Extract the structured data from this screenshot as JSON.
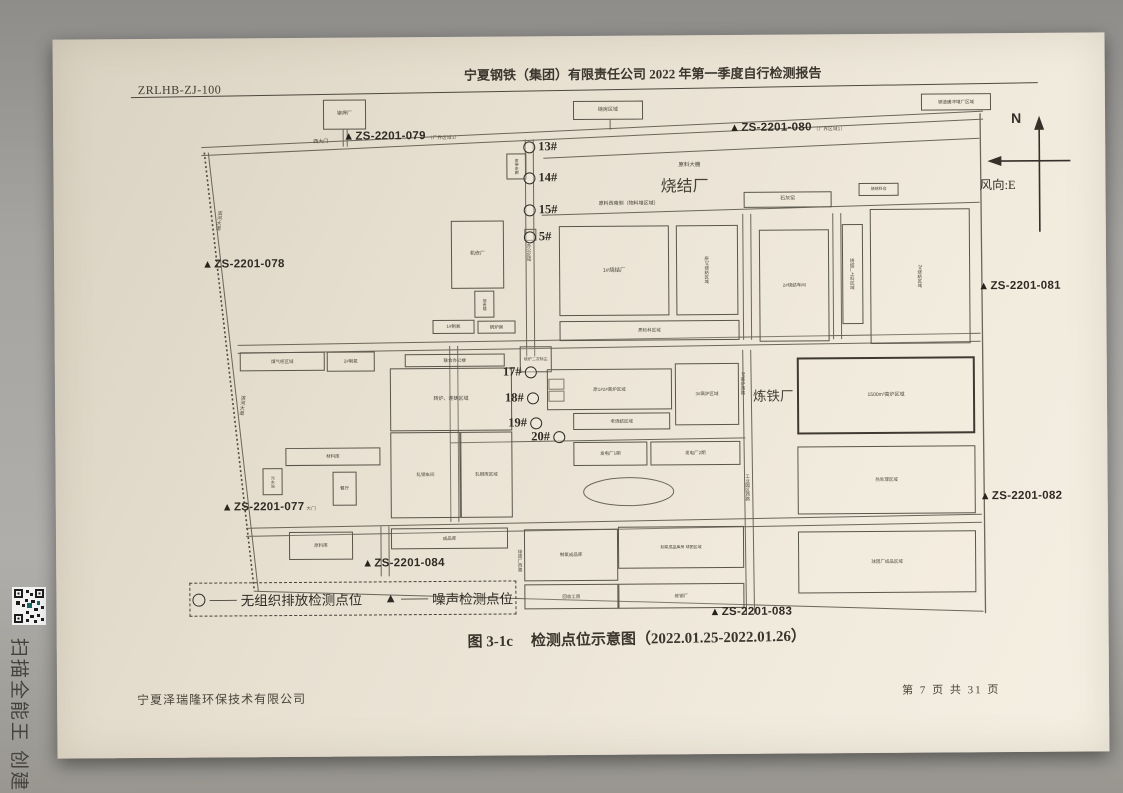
{
  "scanner": {
    "watermark": "扫描全能王 创建"
  },
  "header": {
    "doc_code": "ZRLHB-ZJ-100",
    "title": "宁夏钢铁（集团）有限责任公司 2022 年第一季度自行检测报告"
  },
  "figure": {
    "caption_prefix": "图 3-1c",
    "caption_text": "检测点位示意图（2022.01.25-2022.01.26）"
  },
  "footer": {
    "company": "宁夏泽瑞隆环保技术有限公司",
    "page_info": "第 7 页 共 31 页"
  },
  "compass": {
    "north": "N",
    "wind": "风向:E"
  },
  "legend": {
    "dash": "——",
    "circle_label": "无组织排放检测点位",
    "triangle_symbol": "▲",
    "triangle_label": "噪声检测点位"
  },
  "markers": {
    "triangle": "▲"
  },
  "noise_points": [
    {
      "label": "ZS-2201-077",
      "suffix": "大门"
    },
    {
      "label": "ZS-2201-078",
      "suffix": ""
    },
    {
      "label": "ZS-2201-079",
      "suffix": "（厂界区域1）"
    },
    {
      "label": "ZS-2201-080",
      "suffix": "（厂界区域1）"
    },
    {
      "label": "ZS-2201-081",
      "suffix": ""
    },
    {
      "label": "ZS-2201-082",
      "suffix": ""
    },
    {
      "label": "ZS-2201-083",
      "suffix": ""
    },
    {
      "label": "ZS-2201-084",
      "suffix": ""
    }
  ],
  "emission_points": [
    "13#",
    "14#",
    "15#",
    "5#",
    "17#",
    "18#",
    "19#",
    "20#"
  ],
  "areas": {
    "west_gate": "西大门",
    "raw_shed": "原料大棚",
    "sinter": "烧结厂",
    "raw_sw": "原料西南侧（物料堆区域）",
    "iron": "炼铁厂"
  },
  "roads": {
    "office": "办公区域",
    "binhe": "滨河大道",
    "furnace_w": "3#高炉西路",
    "pellet_w": "球团厂西路",
    "industrial_w": "工业园区西路"
  },
  "buildings": [
    {
      "label": "铆焊厂"
    },
    {
      "label": "磅房区域"
    },
    {
      "label": "钢渣缓冲堆厂区域"
    },
    {
      "label": "石灰窑"
    },
    {
      "label": "烧结料仓"
    },
    {
      "label": "1#烧结厂"
    },
    {
      "label": "原1#烧结区域"
    },
    {
      "label": "2#烧结车间"
    },
    {
      "label": "烧结厂上料区域"
    },
    {
      "label": "2#烧结区域"
    },
    {
      "label": "质检科区域"
    },
    {
      "label": "机修厂"
    },
    {
      "label": "宿舍楼"
    },
    {
      "label": "1#制氧"
    },
    {
      "label": "锅炉房"
    },
    {
      "label": "煤气柜区域"
    },
    {
      "label": "2#制氧"
    },
    {
      "label": "联合办公楼"
    },
    {
      "label": "转炉、连铸区域"
    },
    {
      "label": "轧钢车间"
    },
    {
      "label": "轧钢库区域"
    },
    {
      "label": "材料库"
    },
    {
      "label": "污水站"
    },
    {
      "label": "餐厅"
    },
    {
      "label": "原料库"
    },
    {
      "label": "烧炉二次除尘"
    },
    {
      "label": "原1#2#高炉区域"
    },
    {
      "label": "3#高炉区域"
    },
    {
      "label": "老烧结区域"
    },
    {
      "label": "发电厂1期"
    },
    {
      "label": "发电厂2期"
    },
    {
      "label": "1500m³高炉区域"
    },
    {
      "label": "热处理区域"
    },
    {
      "label": "球团厂成品区域"
    },
    {
      "label": "成品库"
    },
    {
      "label": "制氧成品库"
    },
    {
      "label": "制氧成品库房 球团区域"
    },
    {
      "label": "回收工房"
    },
    {
      "label": "炼钢厂"
    },
    {
      "label": "皮带走廊"
    }
  ]
}
